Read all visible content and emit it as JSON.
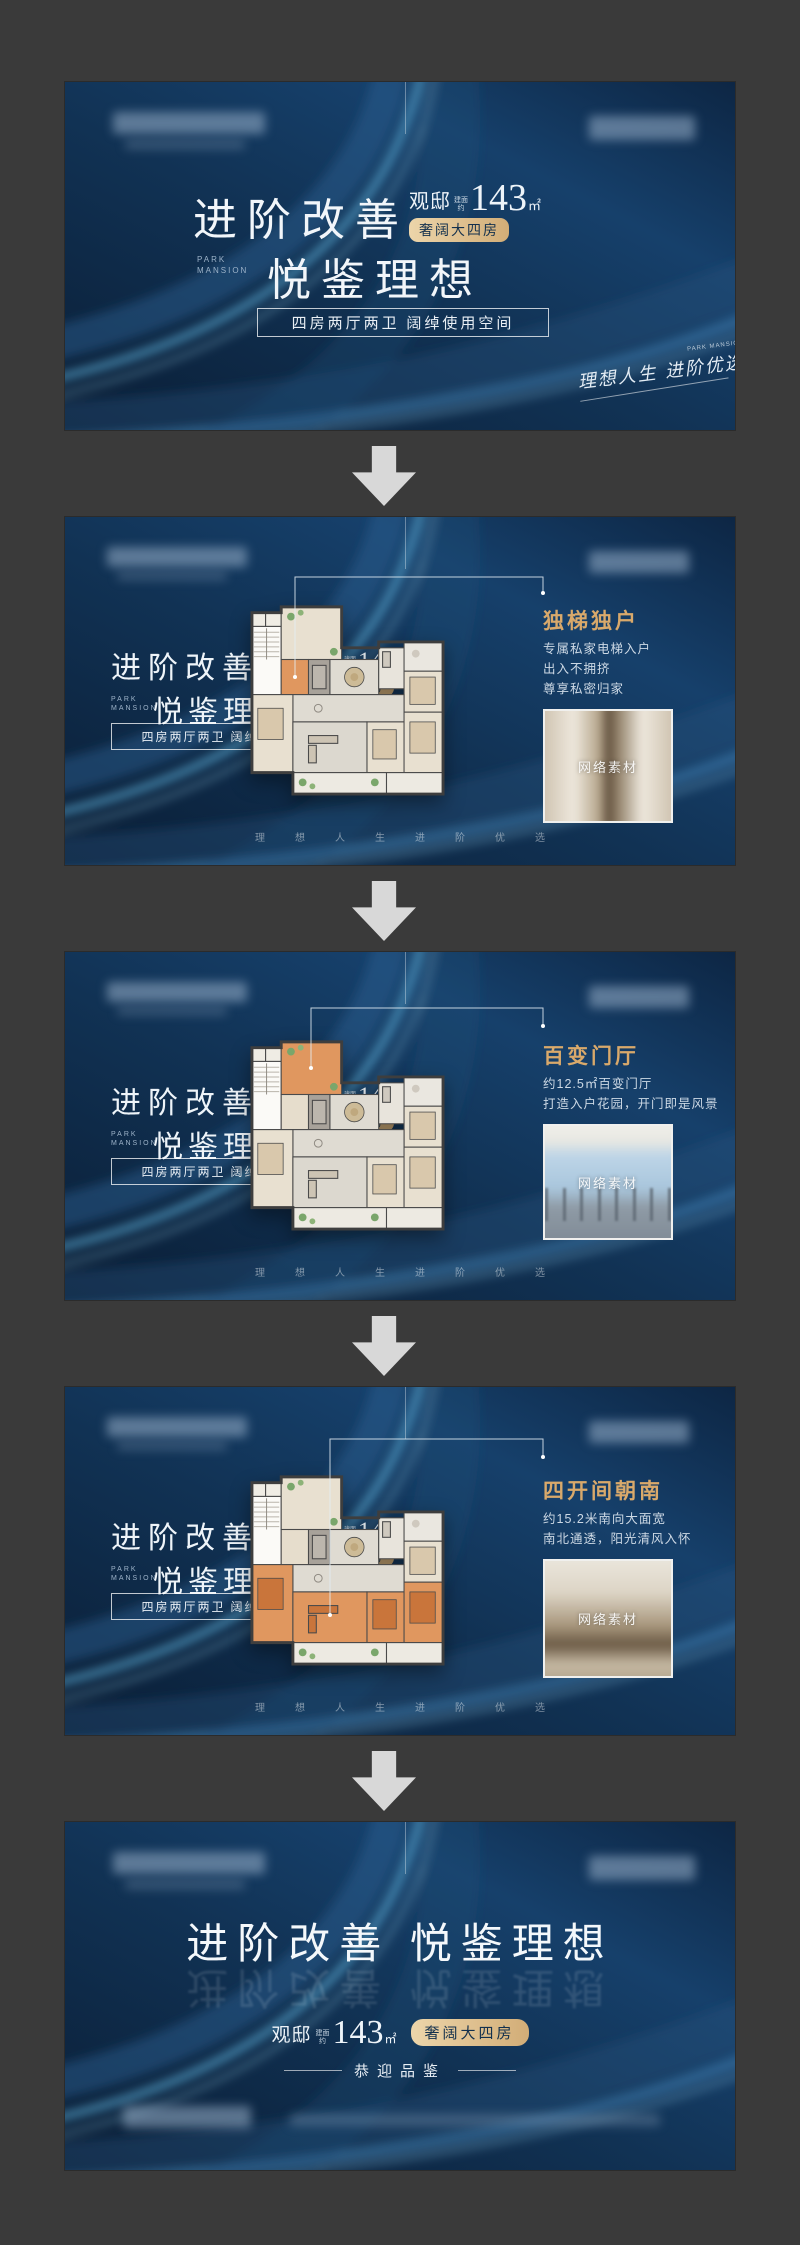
{
  "poster": {
    "watermark": "网络素材",
    "strip": "理想人生进阶优选",
    "left_block": {
      "title1": "进阶改善",
      "title2": "悦鉴理想",
      "eng1": "PARK",
      "eng2": "MANSION",
      "project": "观邸",
      "area_about1": "建面",
      "area_about2": "约",
      "area_value": "143",
      "area_unit": "㎡",
      "badge": "奢阔大四房",
      "box": "四房两厅两卫 阔绰使用空间"
    },
    "banner1": {
      "signature": "理想人生 进阶优选",
      "signature_eng": "PARK MANSION"
    },
    "features": [
      {
        "title": "独梯独户",
        "lines": [
          "专属私家电梯入户",
          "出入不拥挤",
          "尊享私密归家"
        ],
        "highlight": "elevator"
      },
      {
        "title": "百变门厅",
        "lines": [
          "约12.5㎡百变门厅",
          "打造入户花园，开门即是风景"
        ],
        "highlight": "terrace"
      },
      {
        "title": "四开间朝南",
        "lines": [
          "约15.2米南向大面宽",
          "南北通透，阳光清风入怀"
        ],
        "highlight": "south"
      }
    ],
    "banner5": {
      "title": "进阶改善 悦鉴理想",
      "invite": "恭迎品鉴"
    }
  }
}
